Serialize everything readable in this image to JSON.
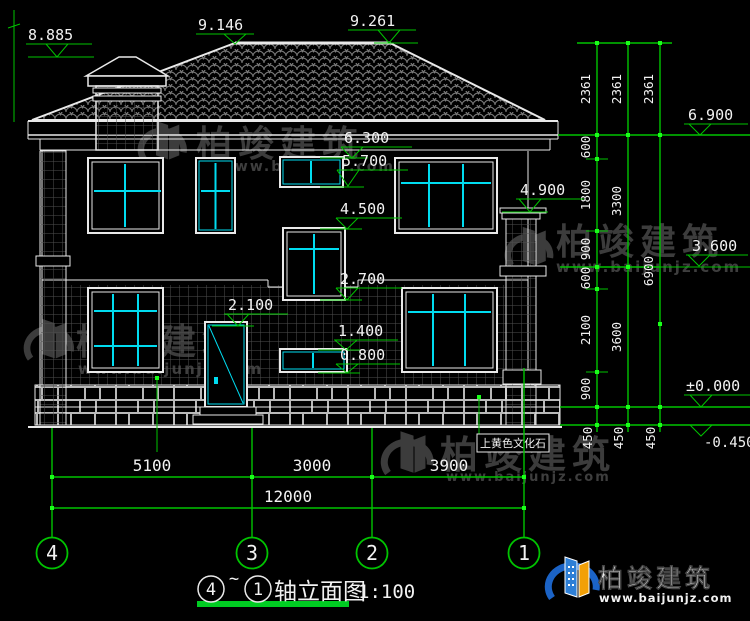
{
  "colors": {
    "background": "#000000",
    "cad_line_white": "#e9e9e9",
    "dimension_green": "#00c400",
    "grip_dot_green": "#1aff1a",
    "mullion_cyan": "#00dcf0",
    "watermark_gray": "#3c3c3c",
    "logo_blue": "#1b63c6",
    "logo_orange": "#f2a007",
    "logo_url_red": "#8a2222",
    "title_underline_green": "#00cc22"
  },
  "watermark": {
    "brand": "柏竣建筑",
    "url": "www.baijunjz.com"
  },
  "logo": {
    "brand": "柏竣建筑",
    "url": "www.baijunjz.com"
  },
  "note": {
    "stone_finish": "上黄色文化石"
  },
  "elevations": {
    "chimney": "8.885",
    "ridge_left": "9.146",
    "ridge_right": "9.261",
    "window_top_2f": "6.300",
    "stair_upper_sill": "5.700",
    "stair_mid_top": "4.500",
    "porch_roof": "4.900",
    "stair_mid_sill": "2.700",
    "door_top": "2.100",
    "stair_low_top": "1.400",
    "stair_low_sill": "0.800",
    "eave": "6.900",
    "floor_2": "3.600",
    "ground": "±0.000",
    "outdoor": "-0.450"
  },
  "dims": {
    "right": {
      "roof": [
        "2361",
        "2361",
        "2361"
      ],
      "inner": [
        "600",
        "1800",
        "900",
        "600",
        "2100",
        "900"
      ],
      "mid": [
        "3300",
        "3600"
      ],
      "total": "6900",
      "footing": [
        "450",
        "450",
        "450"
      ]
    },
    "bottom": {
      "bays": [
        "5100",
        "3000",
        "3900"
      ],
      "total": "12000"
    }
  },
  "axes": {
    "bubbles": [
      "4",
      "3",
      "2",
      "1"
    ]
  },
  "title": {
    "from": "4",
    "tilde": "~",
    "to": "1",
    "text": "轴立面图",
    "scale": "1:100"
  }
}
